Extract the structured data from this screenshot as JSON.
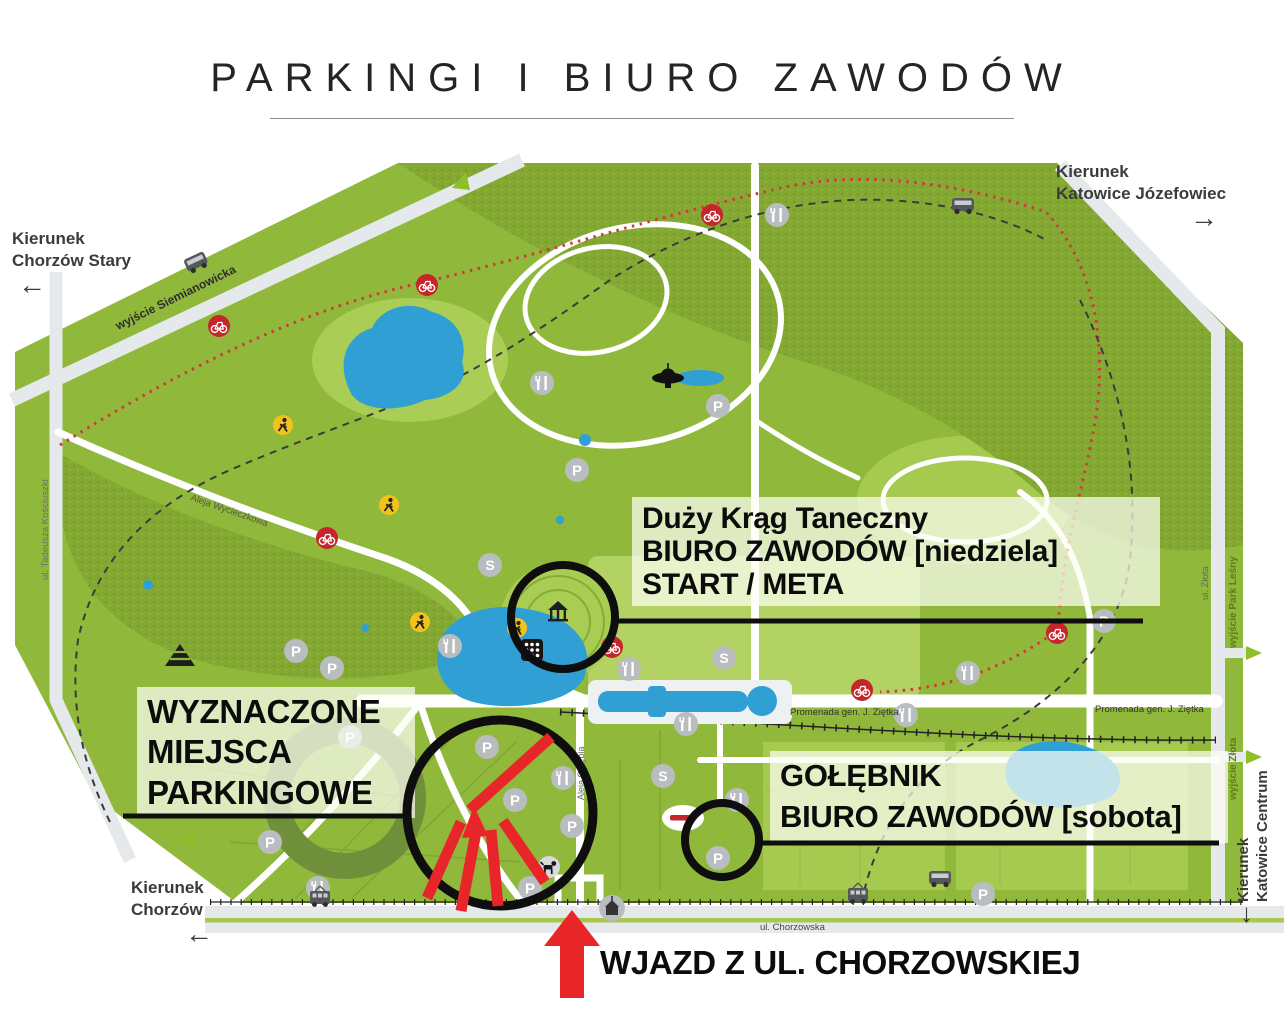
{
  "title": {
    "text": "PARKINGI I BIURO ZAWODÓW"
  },
  "directions": {
    "top_left": {
      "line1": "Kierunek",
      "line2": "Chorzów Stary",
      "arrow": "←"
    },
    "top_right": {
      "line1": "Kierunek",
      "line2": "Katowice Józefowiec",
      "arrow": "→"
    },
    "bottom_left": {
      "line1": "Kierunek",
      "line2": "Chorzów",
      "arrow": "←"
    },
    "right": {
      "line1": "Kierunek",
      "line2": "Katowice Centrum",
      "arrow": "↓"
    }
  },
  "annotations": {
    "sunday": {
      "line1": "Duży  Krąg Taneczny",
      "line2": "BIURO ZAWODÓW [niedziela]",
      "line3": "START / META"
    },
    "parking": {
      "line1": "WYZNACZONE",
      "line2": "MIEJSCA",
      "line3": "PARKINGOWE"
    },
    "saturday": {
      "line1": "GOŁĘBNIK",
      "line2": "BIURO ZAWODÓW [sobota]"
    },
    "entrance": {
      "text": "WJAZD Z UL. CHORZOWSKIEJ"
    }
  },
  "streets": {
    "siemianowicka": "wyjście Siemianowicka",
    "kosciuszki": "ul. Tadeusza Kościuszki",
    "wycieczkowa": "Aleja Wycieczkowa",
    "chorzowska": "ul. Chorzowska",
    "promenada": "Promenada gen. J. Ziętka",
    "promenada2": "Promenada gen. J. Ziętka",
    "zlota": "ul. Złota",
    "wyjscie_zlota": "wyjście Złota",
    "wyjscie_park": "wyjście Park Leśny",
    "golebia": "Aleja Gołębia"
  },
  "icons": {
    "parking_letter": "P",
    "sports_letter": "S"
  },
  "colors": {
    "park_green": "#90b83a",
    "forest_green": "#83a933",
    "light_green": "#aacd55",
    "water_blue": "#2f9fd4",
    "road_gray": "#e6e9eb",
    "accent_red": "#e8262a",
    "annotation_black": "#0e0e0e"
  }
}
